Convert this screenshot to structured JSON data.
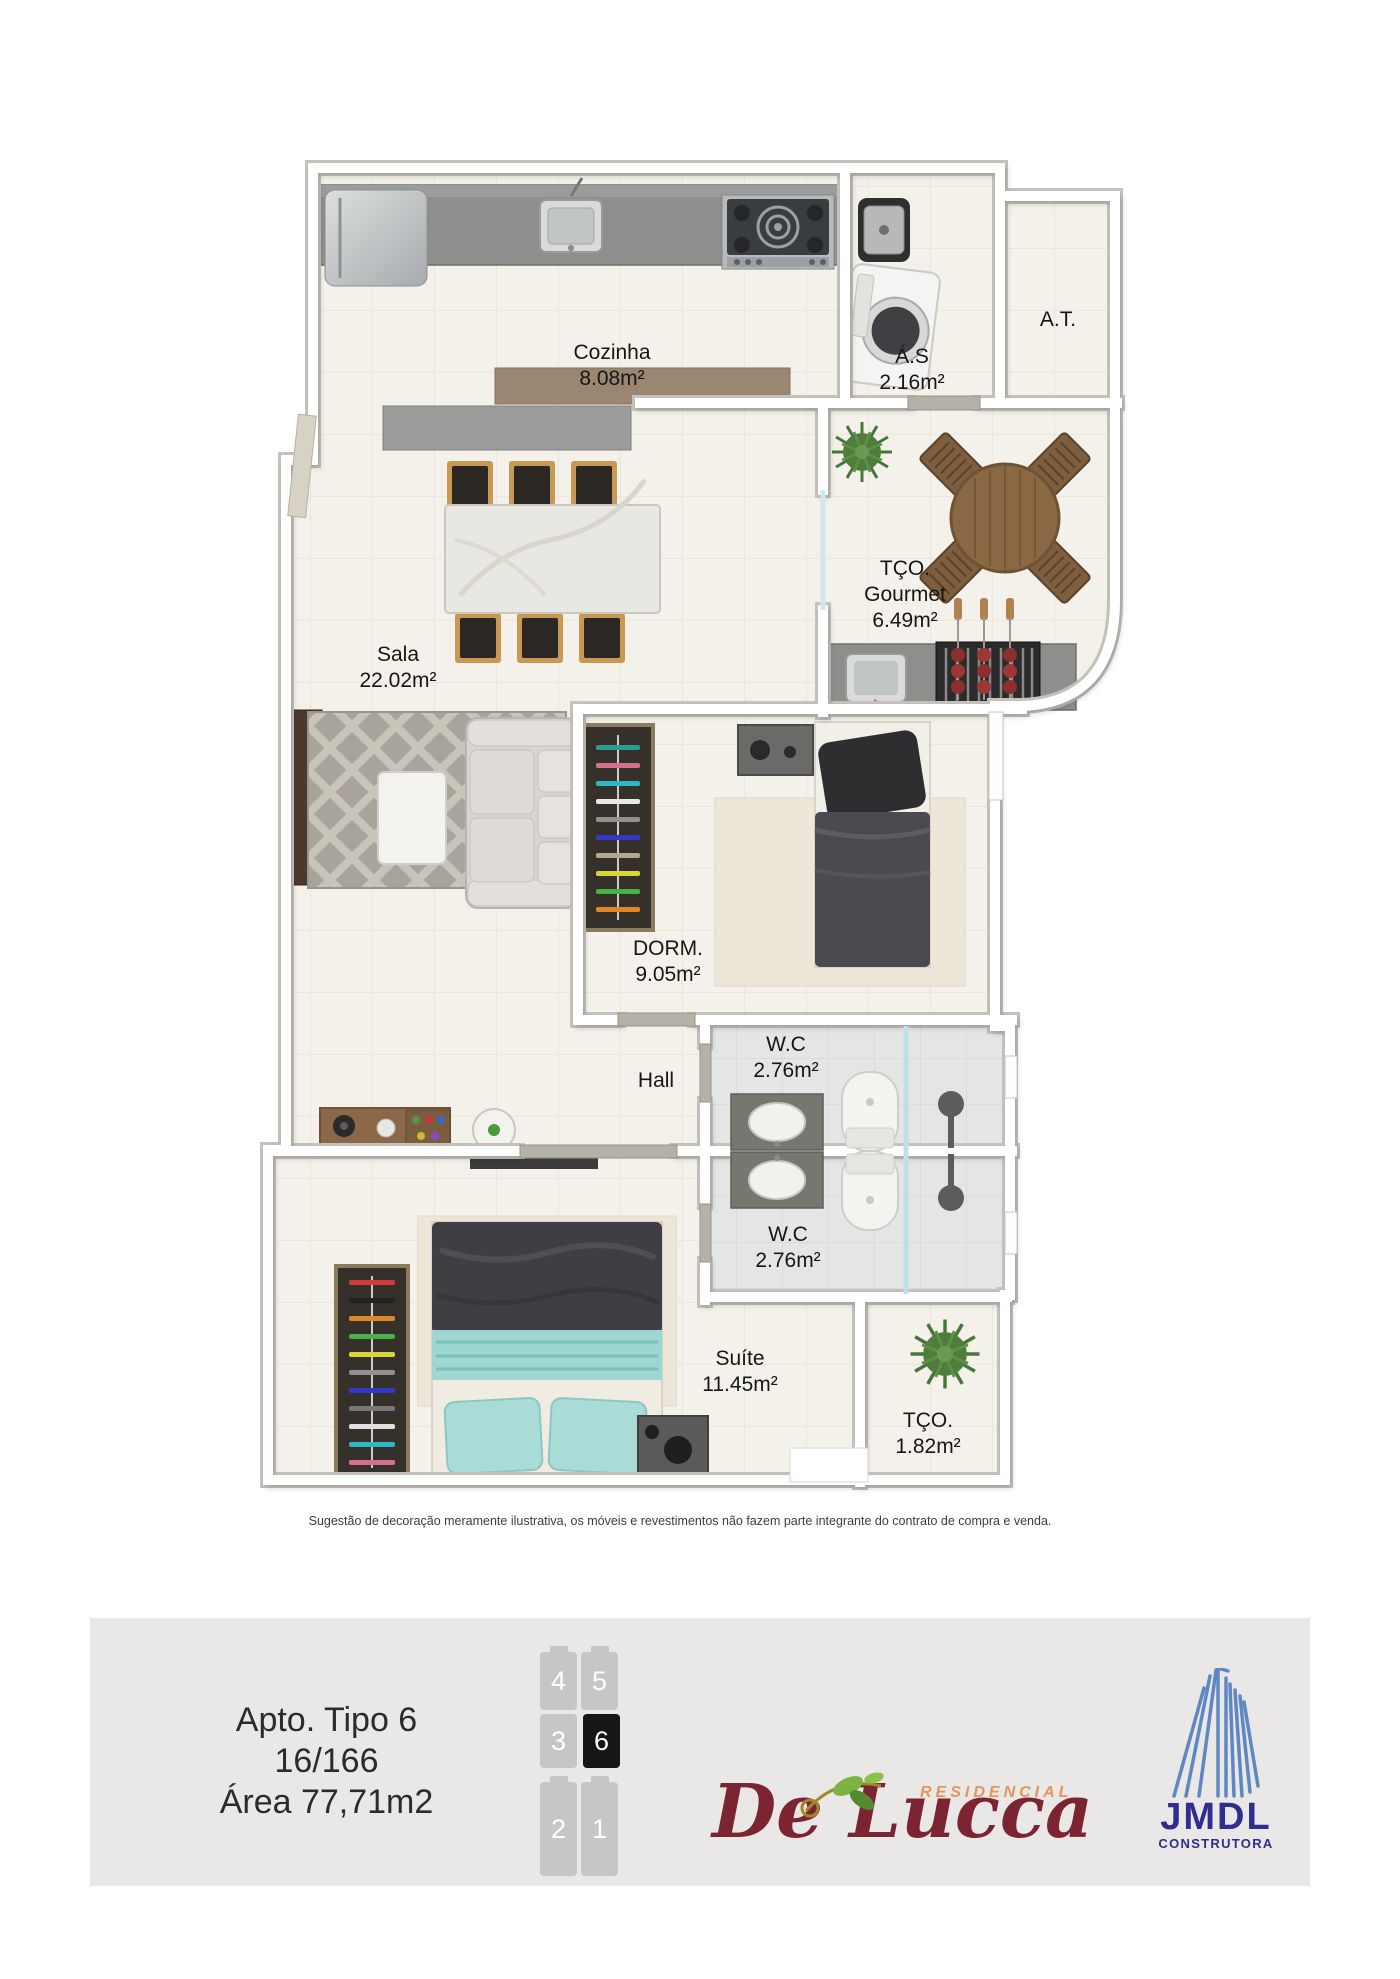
{
  "plan": {
    "rooms": [
      {
        "id": "cozinha",
        "line1": "Cozinha",
        "line2": "8.08m²"
      },
      {
        "id": "area-servico",
        "line1": "Á.S",
        "line2": "2.16m²"
      },
      {
        "id": "area-tecnica",
        "line1": "A.T."
      },
      {
        "id": "terraco-gourmet",
        "line1": "TÇO.",
        "line2": "Gourmet",
        "line3": "6.49m²"
      },
      {
        "id": "sala",
        "line1": "Sala",
        "line2": "22.02m²"
      },
      {
        "id": "dormitorio",
        "line1": "DORM.",
        "line2": "9.05m²"
      },
      {
        "id": "hall",
        "line1": "Hall"
      },
      {
        "id": "wc-social",
        "line1": "W.C",
        "line2": "2.76m²"
      },
      {
        "id": "wc-suite",
        "line1": "W.C",
        "line2": "2.76m²"
      },
      {
        "id": "suite",
        "line1": "Suíte",
        "line2": "11.45m²"
      },
      {
        "id": "terraco",
        "line1": "TÇO.",
        "line2": "1.82m²"
      }
    ],
    "disclaimer": "Sugestão de decoração meramente ilustrativa, os móveis e revestimentos não fazem parte integrante do contrato de compra e venda."
  },
  "footer": {
    "unit_line1": "Apto. Tipo 6",
    "unit_line2": "16/166",
    "unit_line3": "Área 77,71m2",
    "keyplan": {
      "units": [
        {
          "label": "4",
          "active": false
        },
        {
          "label": "5",
          "active": false
        },
        {
          "label": "3",
          "active": false
        },
        {
          "label": "6",
          "active": true
        },
        {
          "label": "2",
          "active": false
        },
        {
          "label": "1",
          "active": false
        }
      ]
    },
    "brand": {
      "top": "RESIDENCIAL",
      "name": "De Lucca"
    },
    "builder": {
      "name": "JMDL",
      "tagline": "CONSTRUTORA"
    }
  },
  "icons": {
    "brand_leaf": "leaf-ornament-icon",
    "builder_building": "building-icon"
  },
  "colors": {
    "brand_maroon": "#7d2433",
    "brand_orange": "#e2955f",
    "builder_blue": "#2f2d8e",
    "building_lightblue": "#5f87c2",
    "keyplan_gray": "#c6c6c6",
    "keyplan_active": "#161616",
    "footer_bg": "#e9e8e7",
    "floor_cream": "#f4f1ea",
    "bath_floor": "#e4e6e5"
  }
}
